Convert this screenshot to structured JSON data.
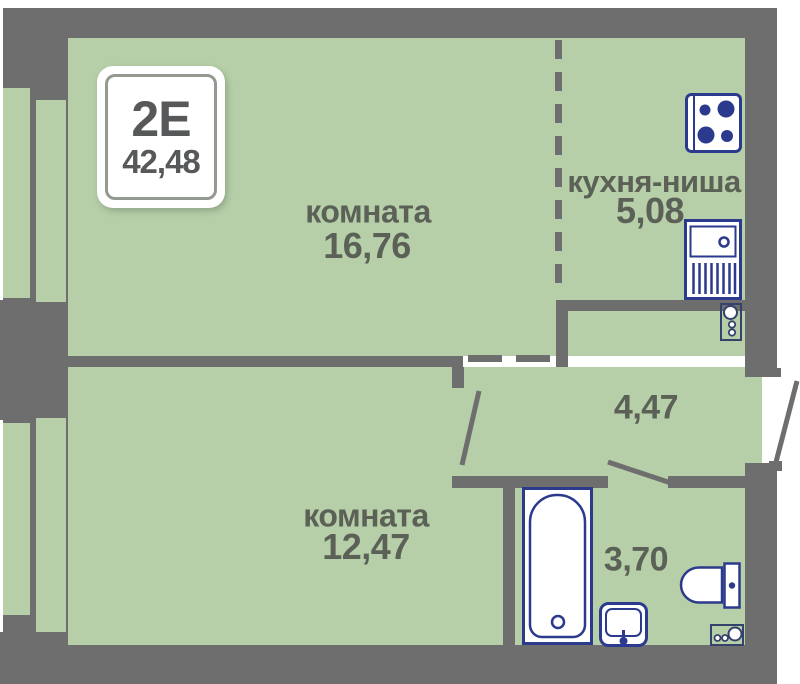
{
  "badge": {
    "type": "2Е",
    "total_area": "42,48"
  },
  "rooms": {
    "room1": {
      "name": "комната",
      "area": "16,76"
    },
    "kitchen": {
      "name": "кухня-ниша",
      "area": "5,08"
    },
    "hallway": {
      "area": "4,47"
    },
    "room2": {
      "name": "комната",
      "area": "12,47"
    },
    "bathroom": {
      "area": "3,70"
    }
  },
  "colors": {
    "walls": "#6e6e6e",
    "floor": "#b6cfa8",
    "fixtures": "#2b3a8c",
    "meters": "#35426b",
    "labels": "#5b6156",
    "badge_text": "#57585a",
    "background": "#ffffff"
  },
  "icons": [
    "stove-icon",
    "kitchen-sink-icon",
    "utility-meter-icon-kitchen",
    "bathtub-icon",
    "washbasin-icon",
    "toilet-icon",
    "utility-meter-icon-bathroom"
  ]
}
